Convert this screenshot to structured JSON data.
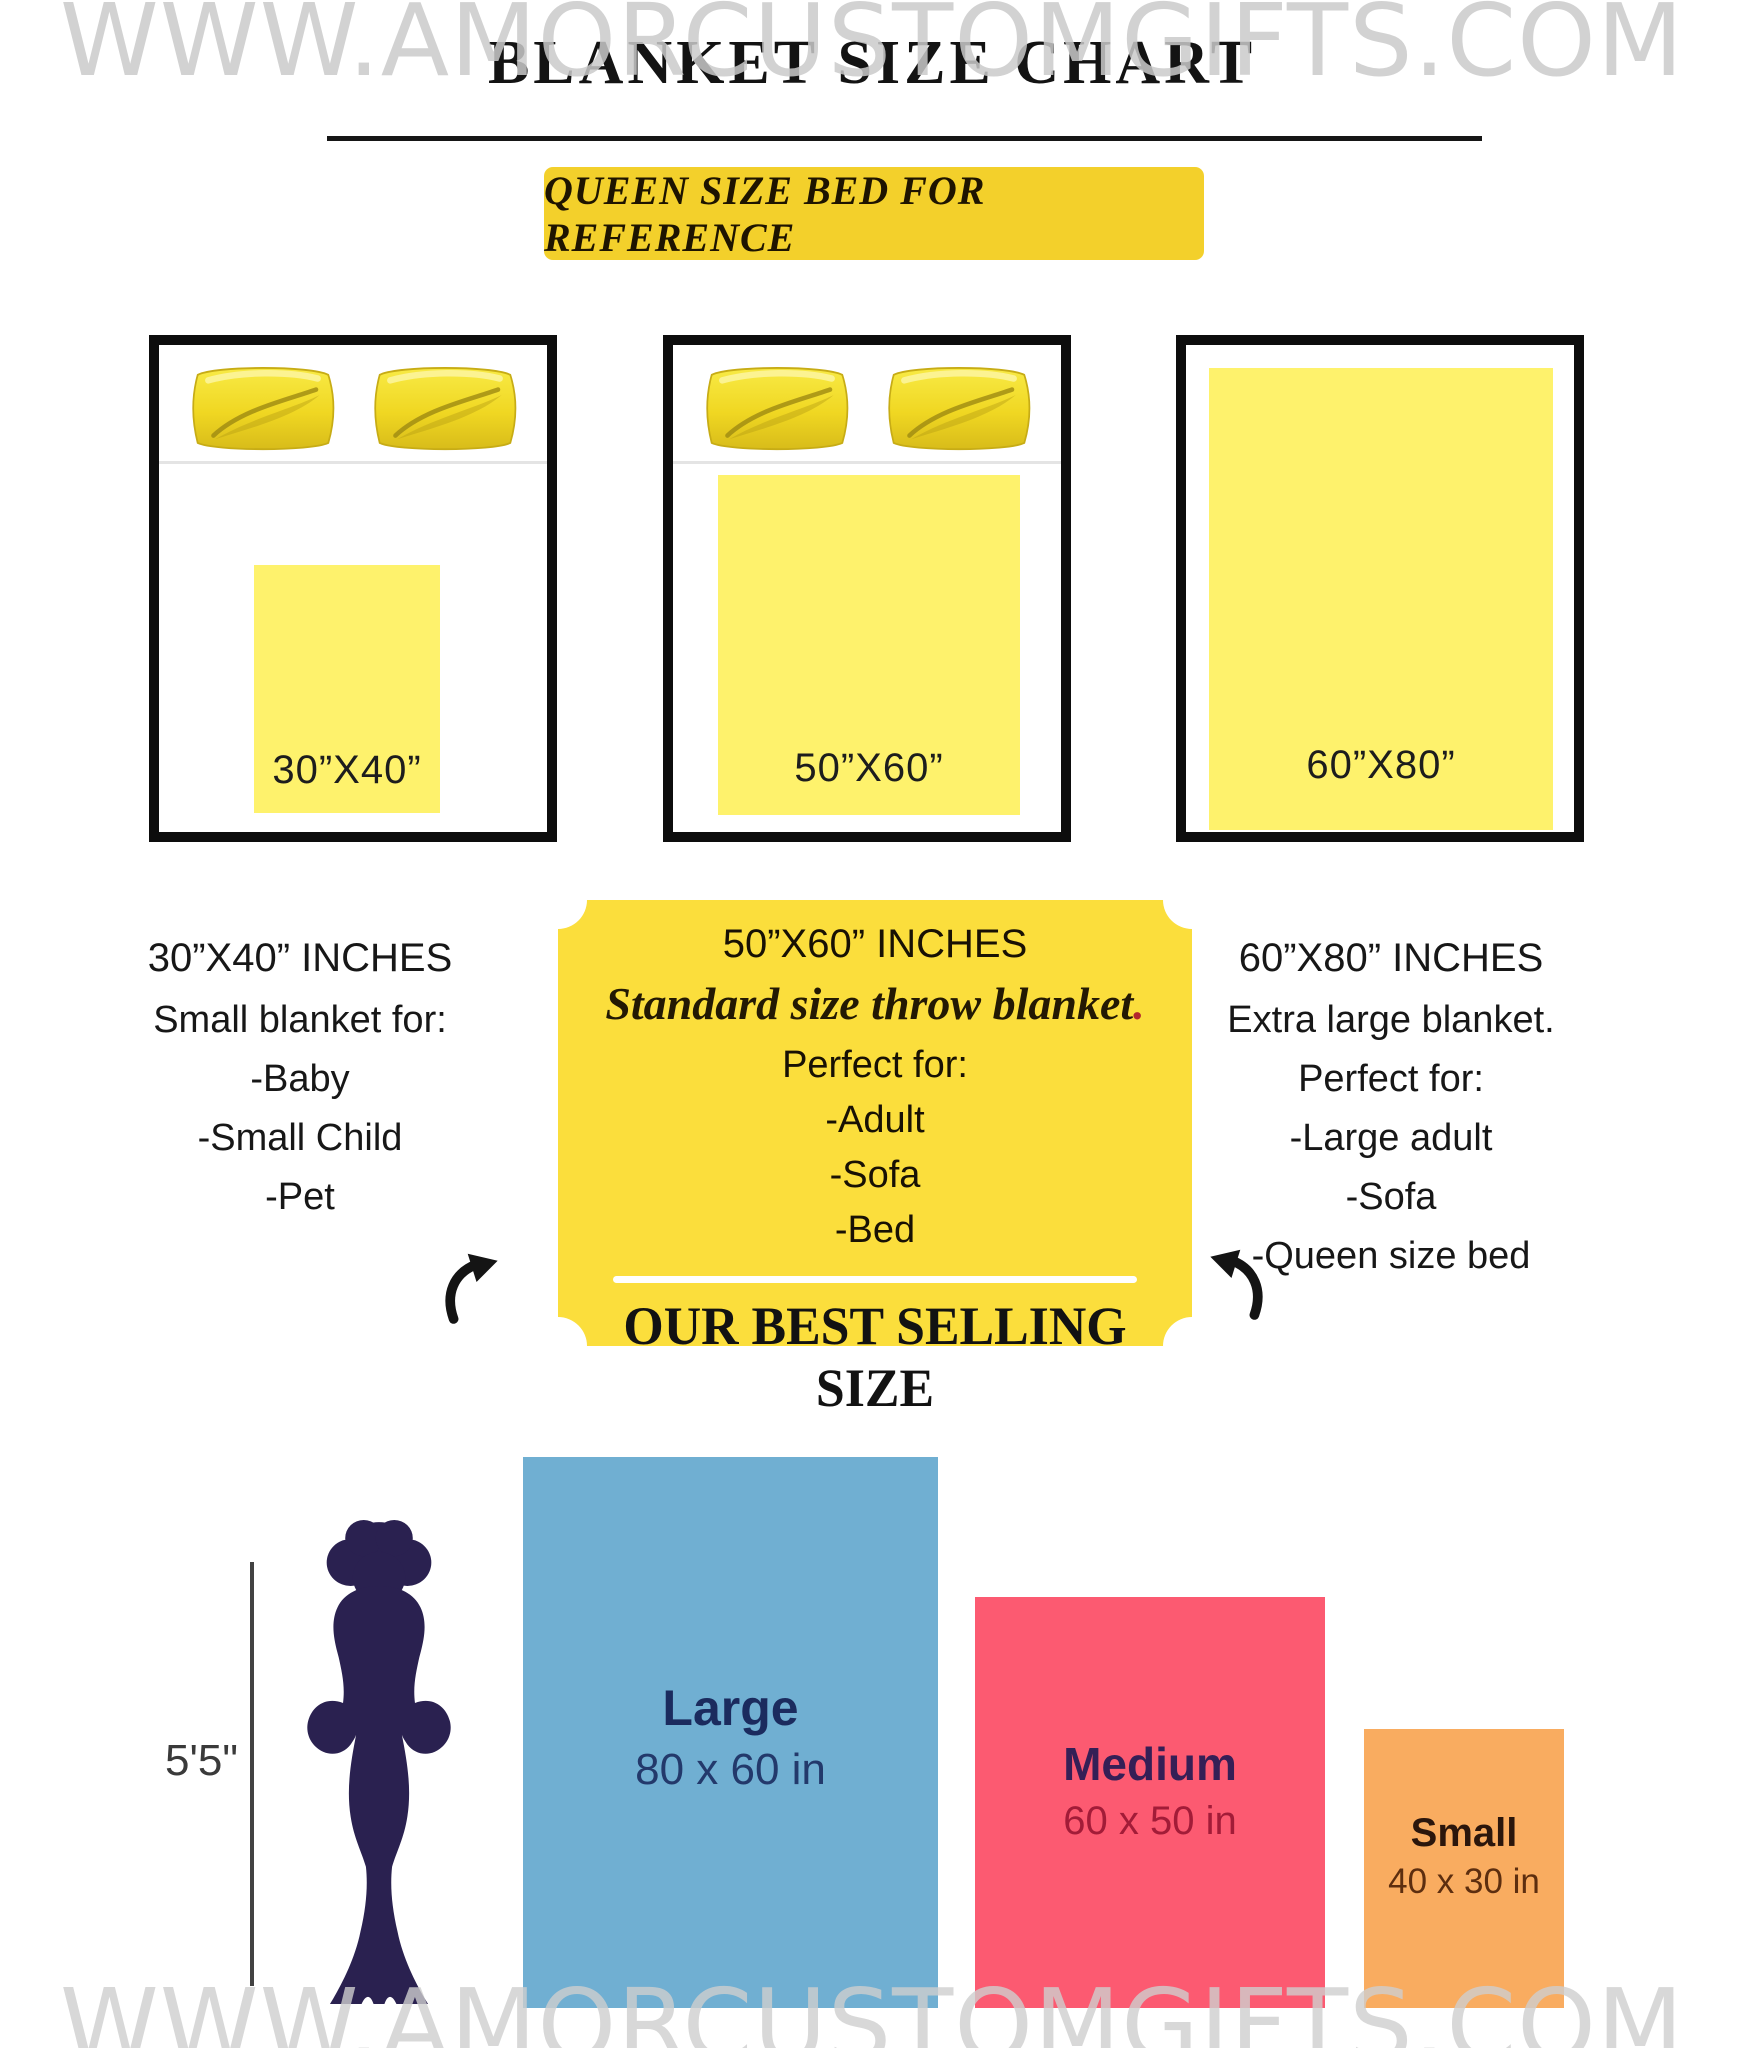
{
  "watermark": {
    "text": "WWW.AMORCUSTOMGIFTS.COM",
    "color": "#C8C8C8"
  },
  "header": {
    "title": "BLANKET SIZE CHART",
    "banner": "QUEEN SIZE BED FOR REFERENCE"
  },
  "beds": [
    {
      "label": "30”X40”"
    },
    {
      "label": "50”X60”"
    },
    {
      "label": "60”X80”"
    }
  ],
  "columns": {
    "left": {
      "title": "30”X40” INCHES",
      "lines": [
        "Small blanket for:",
        "-Baby",
        "-Small Child",
        "-Pet"
      ]
    },
    "center": {
      "title": "50”X60” INCHES",
      "subtitle": "Standard size throw blanket",
      "subtitle_period": ".",
      "intro": "Perfect for:",
      "lines": [
        "-Adult",
        "-Sofa",
        "-Bed"
      ],
      "footer": "OUR BEST SELLING SIZE"
    },
    "right": {
      "title": "60”X80” INCHES",
      "lines": [
        "Extra large blanket.",
        "Perfect for:",
        "-Large adult",
        "-Sofa",
        "-Queen size bed"
      ]
    }
  },
  "comparison": {
    "height_label": "5'5\"",
    "items": [
      {
        "name": "Large",
        "dims": "80 x 60 in",
        "color": "#70AFD2"
      },
      {
        "name": "Medium",
        "dims": "60 x 50 in",
        "color": "#FC5A71"
      },
      {
        "name": "Small",
        "dims": "40 x 30 in",
        "color": "#F9AC60"
      }
    ],
    "silhouette_color": "#2A2150"
  },
  "colors": {
    "banner_yellow": "#F3D02B",
    "card_yellow": "#FBDE3C",
    "bed_blanket_yellow": "#FEF26C",
    "pillow_gold": "#F0D722",
    "bed_border_black": "#0D0D0D",
    "watermark_gray": "#C8C8C8"
  }
}
